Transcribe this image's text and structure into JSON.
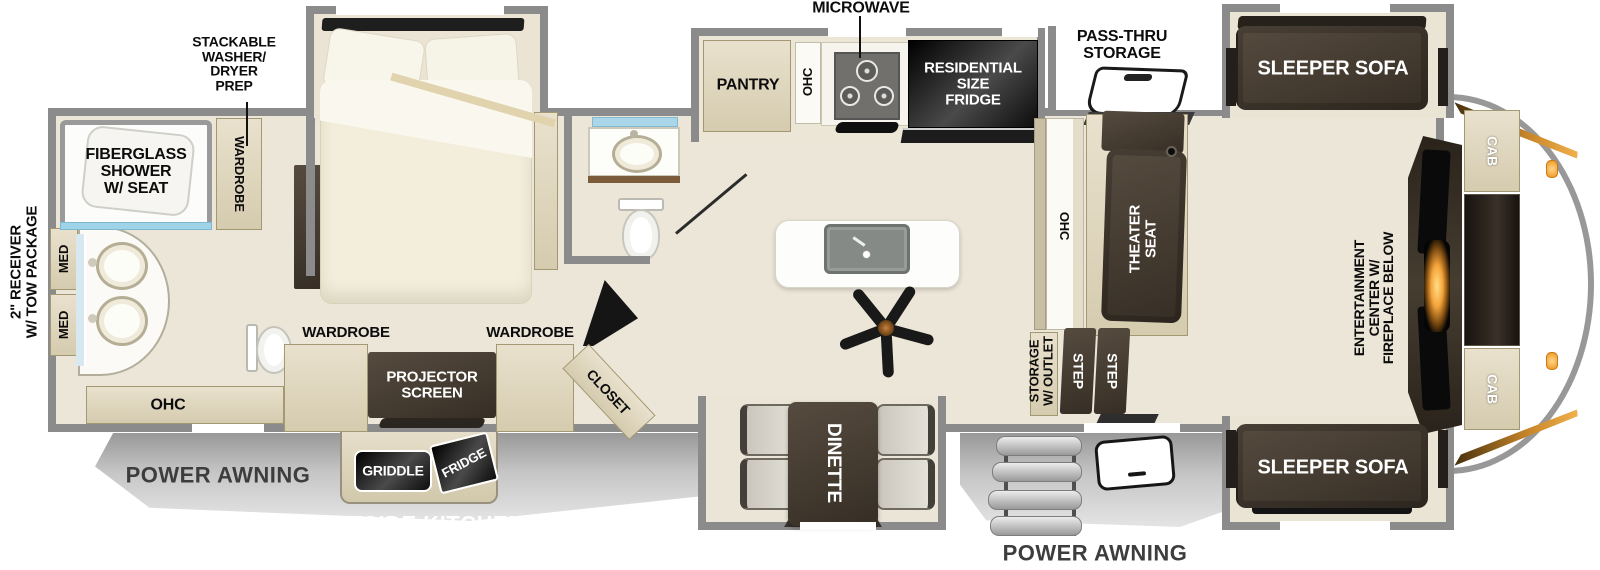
{
  "exterior": {
    "tow_package": "2\" RECEIVER\nW/ TOW PACKAGE",
    "awning_rear": "POWER AWNING",
    "awning_front": "POWER AWNING",
    "outside_kitchen": "OUTSIDE KITCHEN",
    "griddle": "GRIDDLE",
    "outside_fridge": "FRIDGE",
    "pass_thru_storage": "PASS-THRU\nSTORAGE"
  },
  "rear_bath": {
    "shower": "FIBERGLASS\nSHOWER\nW/ SEAT",
    "washer_dryer_prep": "STACKABLE\nWASHER/\nDRYER\nPREP",
    "wardrobe": "WARDROBE",
    "med_upper": "MED",
    "med_lower": "MED",
    "ohc": "OHC"
  },
  "bedroom": {
    "wardrobe_left": "WARDROBE",
    "projector_screen": "PROJECTOR\nSCREEN",
    "wardrobe_right": "WARDROBE",
    "closet": "CLOSET"
  },
  "kitchen": {
    "microwave": "MICROWAVE",
    "pantry": "PANTRY",
    "ohc": "OHC",
    "residential_fridge": "RESIDENTIAL\nSIZE\nFRIDGE"
  },
  "living": {
    "ohc": "OHC",
    "theater_seat": "THEATER\nSEAT",
    "sofa_top": "SLEEPER SOFA",
    "sofa_bottom": "SLEEPER SOFA",
    "storage_outlet": "STORAGE\nW/ OUTLET",
    "step_1": "STEP",
    "step_2": "STEP",
    "dinette": "DINETTE",
    "entertainment_center": "ENTERTAINMENT\nCENTER W/\nFIREPLACE BELOW",
    "cab_upper": "CAB",
    "cab_lower": "CAB"
  },
  "colors": {
    "wall": "#8b8b8b",
    "cabinet_tan": "#ddd4bc",
    "dark_furniture": "#443a30",
    "appliance_black": "#151515",
    "glass_blue": "#a9d6e8",
    "fireplace_glow": "#f5a43a",
    "awning_gray": "#c2c2c2"
  }
}
